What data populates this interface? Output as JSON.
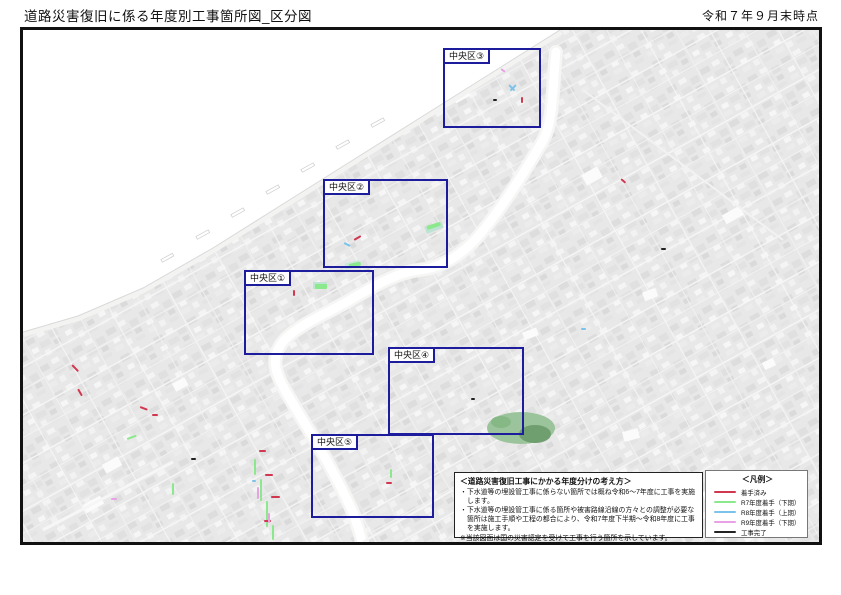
{
  "header": {
    "title": "道路災害復旧に係る年度別工事箇所図_区分図",
    "date_label": "令和７年９月末時点"
  },
  "districts": [
    {
      "label": "中央区③"
    },
    {
      "label": "中央区②"
    },
    {
      "label": "中央区①"
    },
    {
      "label": "中央区④"
    },
    {
      "label": "中央区⑤"
    }
  ],
  "note_box": {
    "title": "＜道路災害復旧工事にかかる年度分けの考え方＞",
    "lines": [
      "・下水道等の埋設管工事に係らない箇所では概ね令和6～7年度に工事を実施します。",
      "・下水道等の埋設管工事に係る箇所や被害路線沿線の方々との調整が必要な箇所は施工手順や工程の都合により、令和7年度下半期～令和8年度に工事を実施します。",
      "※当該図面は国の災害認定を受けて工事を行う箇所を示しています。",
      "※当該図面は現時点での計画であり、地元調整の内容や工事の進捗状況などに応じて変更することがあります。"
    ]
  },
  "legend": {
    "title": "＜凡例＞",
    "items": [
      {
        "label": "着手済み",
        "color": "#d23750"
      },
      {
        "label": "R7年度着手（下期）",
        "color": "#8ce88c"
      },
      {
        "label": "R8年度着手（上期）",
        "color": "#7cc3eb"
      },
      {
        "label": "R9年度着手（下期）",
        "color": "#e9a0e5"
      },
      {
        "label": "工事完了",
        "color": "#222222"
      }
    ]
  },
  "map": {
    "district_border_color": "#1c1c9c",
    "marks": [
      [
        486,
        54,
        8,
        45,
        2
      ],
      [
        493,
        54,
        8,
        135,
        2
      ],
      [
        499,
        66,
        6,
        90,
        0
      ],
      [
        470,
        69,
        4,
        0,
        4
      ],
      [
        478,
        38,
        5,
        35,
        3
      ],
      [
        321,
        212,
        7,
        25,
        2
      ],
      [
        331,
        209,
        8,
        -30,
        0
      ],
      [
        404,
        196,
        14,
        -18,
        1,
        4
      ],
      [
        326,
        234,
        12,
        -12,
        1,
        4
      ],
      [
        271,
        259,
        6,
        90,
        0
      ],
      [
        292,
        254,
        12,
        0,
        1,
        5
      ],
      [
        448,
        368,
        4,
        0,
        4
      ],
      [
        368,
        438,
        9,
        90,
        1
      ],
      [
        363,
        452,
        6,
        0,
        0
      ],
      [
        232,
        428,
        16,
        90,
        1
      ],
      [
        238,
        448,
        22,
        90,
        1
      ],
      [
        244,
        470,
        26,
        90,
        1
      ],
      [
        250,
        494,
        15,
        90,
        1
      ],
      [
        236,
        420,
        7,
        0,
        0
      ],
      [
        242,
        444,
        8,
        0,
        0
      ],
      [
        248,
        466,
        9,
        0,
        0
      ],
      [
        241,
        490,
        7,
        0,
        0
      ],
      [
        235,
        456,
        12,
        90,
        3
      ],
      [
        246,
        482,
        10,
        90,
        3
      ],
      [
        229,
        450,
        4,
        0,
        2
      ],
      [
        49,
        334,
        9,
        45,
        0
      ],
      [
        55,
        358,
        8,
        60,
        0
      ],
      [
        117,
        376,
        8,
        20,
        0
      ],
      [
        129,
        384,
        6,
        0,
        0
      ],
      [
        104,
        408,
        10,
        -20,
        1
      ],
      [
        150,
        452,
        12,
        90,
        1
      ],
      [
        88,
        468,
        6,
        0,
        3
      ],
      [
        168,
        428,
        5,
        0,
        4
      ],
      [
        598,
        148,
        6,
        40,
        0
      ],
      [
        638,
        218,
        5,
        0,
        4
      ],
      [
        558,
        298,
        5,
        0,
        2
      ]
    ]
  }
}
